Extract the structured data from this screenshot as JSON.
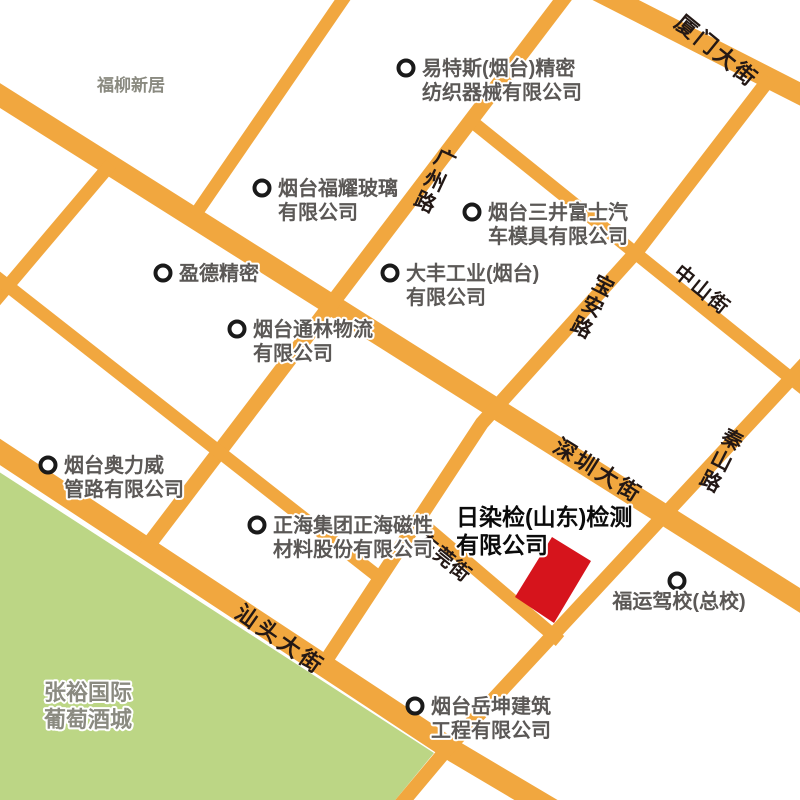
{
  "colors": {
    "background": "#ffffff",
    "road": "#F1A73F",
    "green_area": "#BCD685",
    "building_red": "#D6141C",
    "poi_text": "#5B5856",
    "area_text": "#8A8A80",
    "road_text": "#231815",
    "marker_ring": "#1A1A1A",
    "highlight_text": "#0B0B0B"
  },
  "roads": {
    "xiamen": "厦门大街",
    "guangzhou": "广州路",
    "zhongshan": "中山街",
    "baoan": "宝安路",
    "qinshan": "秦山路",
    "shenzhen": "深圳大街",
    "dongguan": "东莞街",
    "shantou": "汕头大街"
  },
  "areas": {
    "fuliu": "福柳新居",
    "zhangyu_line1": "张裕国际",
    "zhangyu_line2": "葡萄酒城"
  },
  "highlight": {
    "line1": "日染检(山东)检测",
    "line2": "有限公司"
  },
  "pois": {
    "yitesi": {
      "l1": "易特斯(烟台)精密",
      "l2": "纺织器械有限公司"
    },
    "fuyao": {
      "l1": "烟台福耀玻璃",
      "l2": "有限公司"
    },
    "yingde": {
      "l1": "盈德精密"
    },
    "sanjing": {
      "l1": "烟台三井富士汽",
      "l2": "车模具有限公司"
    },
    "dafeng": {
      "l1": "大丰工业(烟台)",
      "l2": "有限公司"
    },
    "tonglin": {
      "l1": "烟台通林物流",
      "l2": "有限公司"
    },
    "aoliwei": {
      "l1": "烟台奥力威",
      "l2": "管路有限公司"
    },
    "zhenghai": {
      "l1": "正海集团正海磁性",
      "l2": "材料股份有限公司"
    },
    "fuyun": {
      "l1": "福运驾校(总校)"
    },
    "yuekun": {
      "l1": "烟台岳坤建筑",
      "l2": "工程有限公司"
    }
  }
}
